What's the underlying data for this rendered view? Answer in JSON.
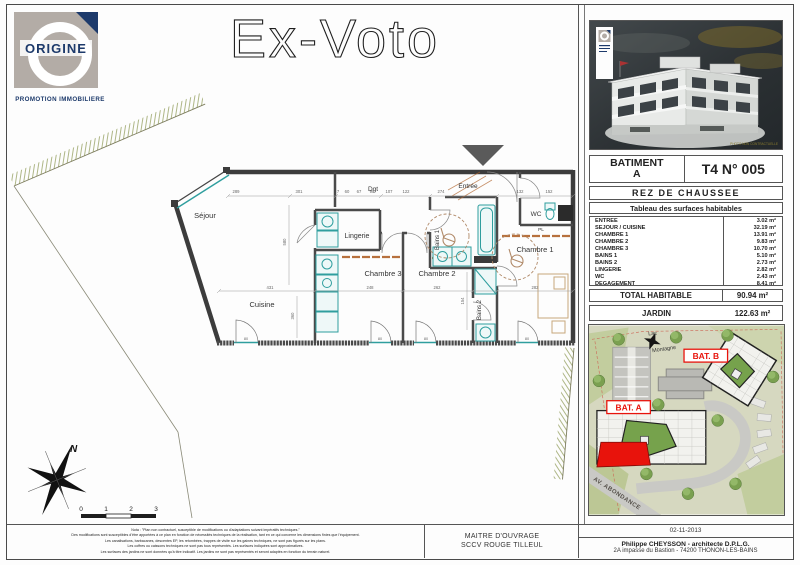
{
  "page": {
    "title": "Ex-Voto"
  },
  "logo": {
    "brand": "ORIGINE",
    "tagline": "PROMOTION IMMOBILIERE"
  },
  "plan": {
    "rooms": [
      "Séjour",
      "Dgt",
      "Entrée",
      "Lingerie",
      "WC",
      "Chambre 3",
      "Chambre 2",
      "Chambre 1",
      "Cuisine",
      "Bains 1",
      "Bains 2",
      "PL"
    ],
    "dims_top": [
      "289",
      "301",
      "7",
      "60",
      "67",
      "90",
      "107",
      "122",
      "274",
      "132",
      "152"
    ],
    "dims_mid": [
      "431",
      "248",
      "262",
      "282"
    ],
    "dims_vert": [
      "580",
      "360",
      "154"
    ],
    "door_label": "80",
    "north_label": "N",
    "scale_ticks": [
      "0",
      "1",
      "2",
      "3"
    ]
  },
  "unit_card": {
    "building_label": "BATIMENT",
    "building_value": "A",
    "unit_ref": "T4 N° 005",
    "floor": "REZ DE CHAUSSEE",
    "table_title": "Tableau des surfaces habitables",
    "rows": [
      {
        "label": "ENTREE",
        "value": "3.02 m²"
      },
      {
        "label": "SEJOUR / CUISINE",
        "value": "32.19 m²"
      },
      {
        "label": "CHAMBRE 1",
        "value": "13.91 m²"
      },
      {
        "label": "CHAMBRE 2",
        "value": "9.83 m²"
      },
      {
        "label": "CHAMBRE 3",
        "value": "10.70 m²"
      },
      {
        "label": "BAINS 1",
        "value": "5.10 m²"
      },
      {
        "label": "BAINS 2",
        "value": "2.73 m²"
      },
      {
        "label": "LINGERIE",
        "value": "2.82 m²"
      },
      {
        "label": "WC",
        "value": "2.43 m²"
      },
      {
        "label": "DEGAGEMENT",
        "value": "8.41 m²"
      }
    ],
    "total_label": "TOTAL HABITABLE",
    "total_value": "90.94 m²",
    "garden_label": "JARDIN",
    "garden_value": "122.63 m²",
    "photo_credit": "PHOTO NON CONTRACTUELLE"
  },
  "site_plan": {
    "lac": "Lac",
    "montagne": "Montagne",
    "bat_a": "BAT. A",
    "bat_b": "BAT. B",
    "street": "AV. ABONDANCE"
  },
  "footer": {
    "disclaimer_lines": [
      "Nota : \"Plan non contractuel, susceptible de modifications ou d'adaptations suivant impératifs techniques.\"",
      "Des modifications sont susceptibles d'être apportées à ce plan en fonction de nécessités techniques de la réalisation, tant en ce qui concerne les dimensions finies que l'équipement.",
      "Les canalisations, barbacanes, descentes EP, les retombées, trappes de visite sur les gaines techniques, ne sont pas figurés sur les plans.",
      "Les coffres ou caissons techniques ne sont pas tous représentés. Les surfaces indiquées sont approximatives.",
      "Les surfaces des jardins ne sont données qu'à titre indicatif. Les jardins ne sont pas représentés et seront adaptés en fonction du terrain naturel."
    ],
    "client_role": "MAITRE D'OUVRAGE",
    "client_name": "SCCV ROUGE TILLEUL",
    "date": "02-11-2013",
    "architect": "Philippe CHEYSSON - architecte D.P.L.G.",
    "architect_address": "2A impasse du Bastion - 74200 THONON-LES-BAINS"
  },
  "colors": {
    "accent_red": "#E8130C",
    "fixture_teal": "#2F9E9E",
    "brand_navy": "#1D3A6B",
    "wall_dark": "#3C3C3C",
    "hatch_olive": "#9AA468"
  }
}
